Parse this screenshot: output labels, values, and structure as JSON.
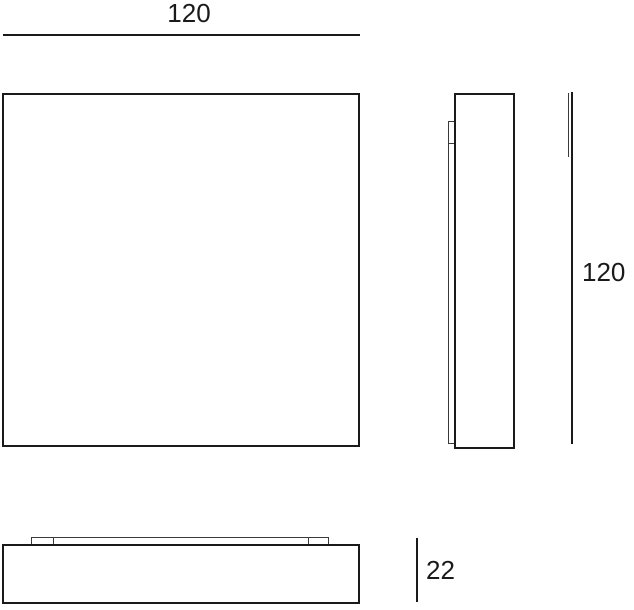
{
  "drawing": {
    "title": "panel-dimension-drawing",
    "line_color": "#1a1a1a",
    "background_color": "#ffffff",
    "dimensions": {
      "width_label": "120",
      "height_label": "120",
      "depth_label": "22"
    },
    "views": {
      "front": "square panel front view",
      "side": "side profile with back plate and mounting bracket",
      "bottom": "bottom view with mounting strip"
    }
  }
}
